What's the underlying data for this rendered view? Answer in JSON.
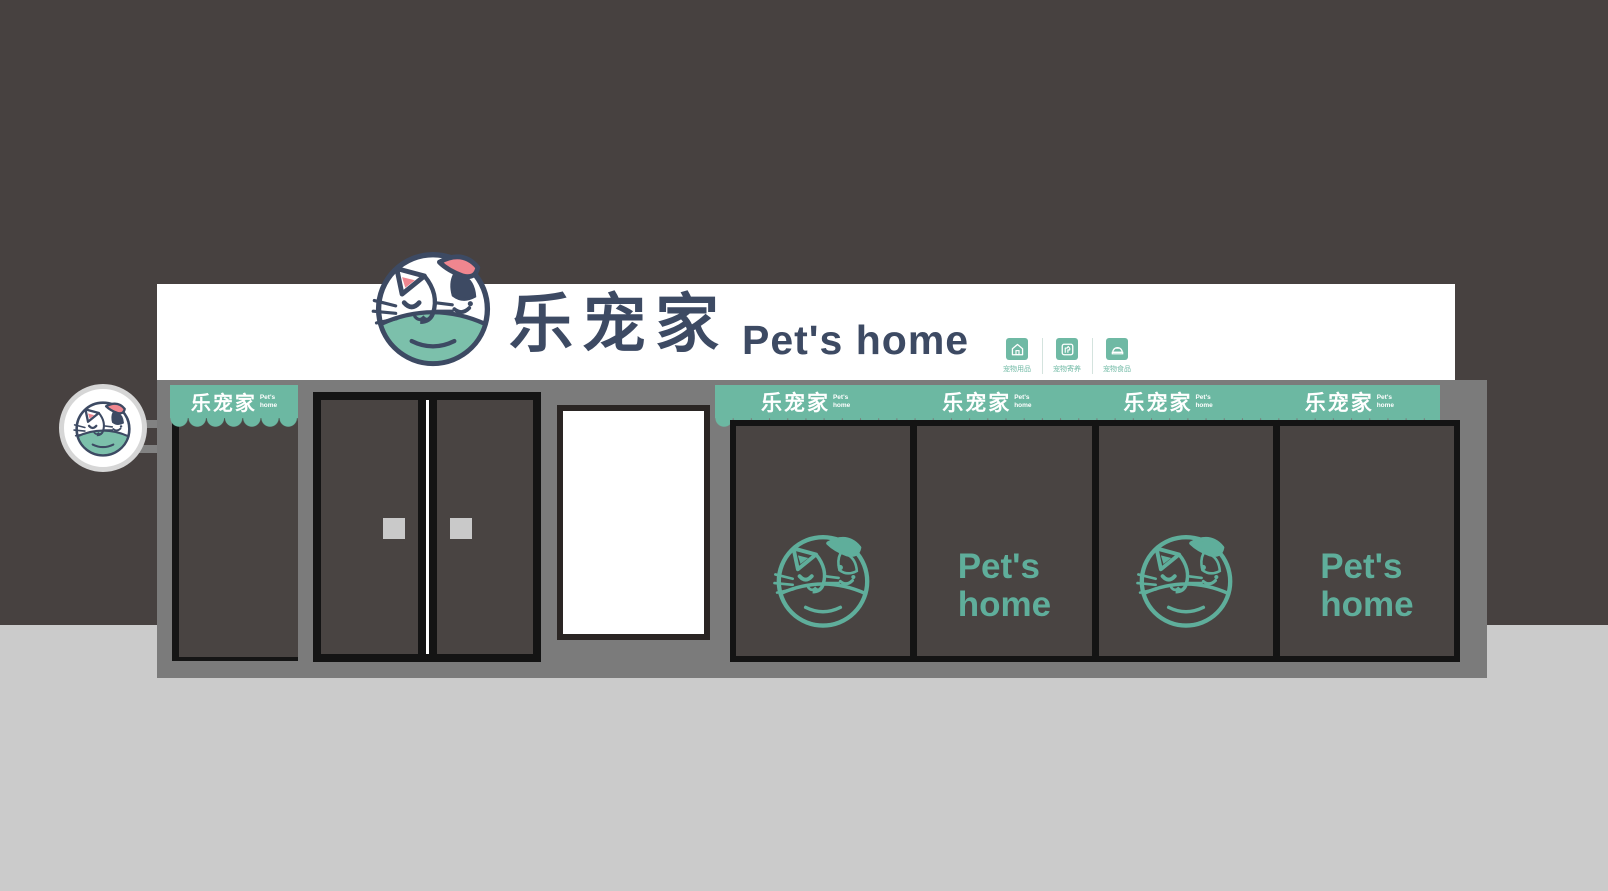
{
  "brand": {
    "cn": "乐宠家",
    "en": "Pet's home"
  },
  "signboard": {
    "brand_cn": "乐宠家",
    "brand_en": "Pet's home",
    "services": [
      {
        "icon": "house-icon",
        "label": "宠物用品"
      },
      {
        "icon": "dog-icon",
        "label": "宠物寄养"
      },
      {
        "icon": "food-bowl-icon",
        "label": "宠物食品"
      }
    ]
  },
  "awning": {
    "cn": "乐宠家",
    "en_line1": "Pet's",
    "en_line2": "home"
  },
  "windows": {
    "panels": [
      {
        "content": "logo"
      },
      {
        "content": "text",
        "line1": "Pet's",
        "line2": "home"
      },
      {
        "content": "logo"
      },
      {
        "content": "text",
        "line1": "Pet's",
        "line2": "home"
      }
    ]
  },
  "colors": {
    "teal": "#6cb8a2",
    "teal_text": "#5fae9b",
    "navy": "#3d4a63",
    "pink": "#f0868f",
    "wall": "#474140",
    "ground": "#cbcbcb",
    "facade_gray": "#7b7b7b",
    "panel_dark": "#494442",
    "frame_black": "#151515",
    "white": "#ffffff"
  }
}
